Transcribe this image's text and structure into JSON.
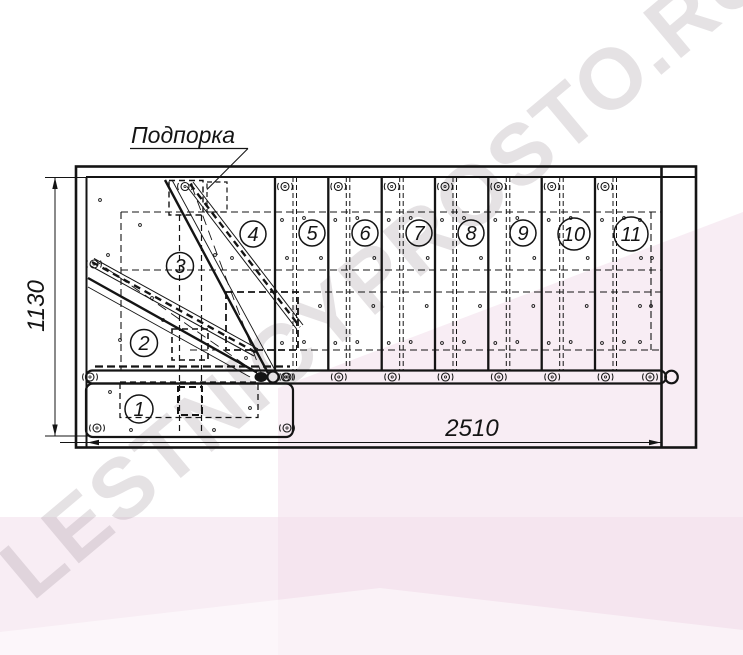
{
  "drawing": {
    "callout_label": "Подпорка",
    "dim_vertical": "1130",
    "dim_horizontal": "2510",
    "steps": [
      "1",
      "2",
      "3",
      "4",
      "5",
      "6",
      "7",
      "8",
      "9",
      "10",
      "11"
    ]
  },
  "watermark": {
    "text": "LESTNICYPROSTO.RU",
    "pink": "#f3dfeb",
    "pink_light": "#ffffff",
    "text_color": "rgba(150,140,148,0.25)"
  },
  "colors": {
    "ink": "#141414",
    "background": "#ffffff"
  }
}
